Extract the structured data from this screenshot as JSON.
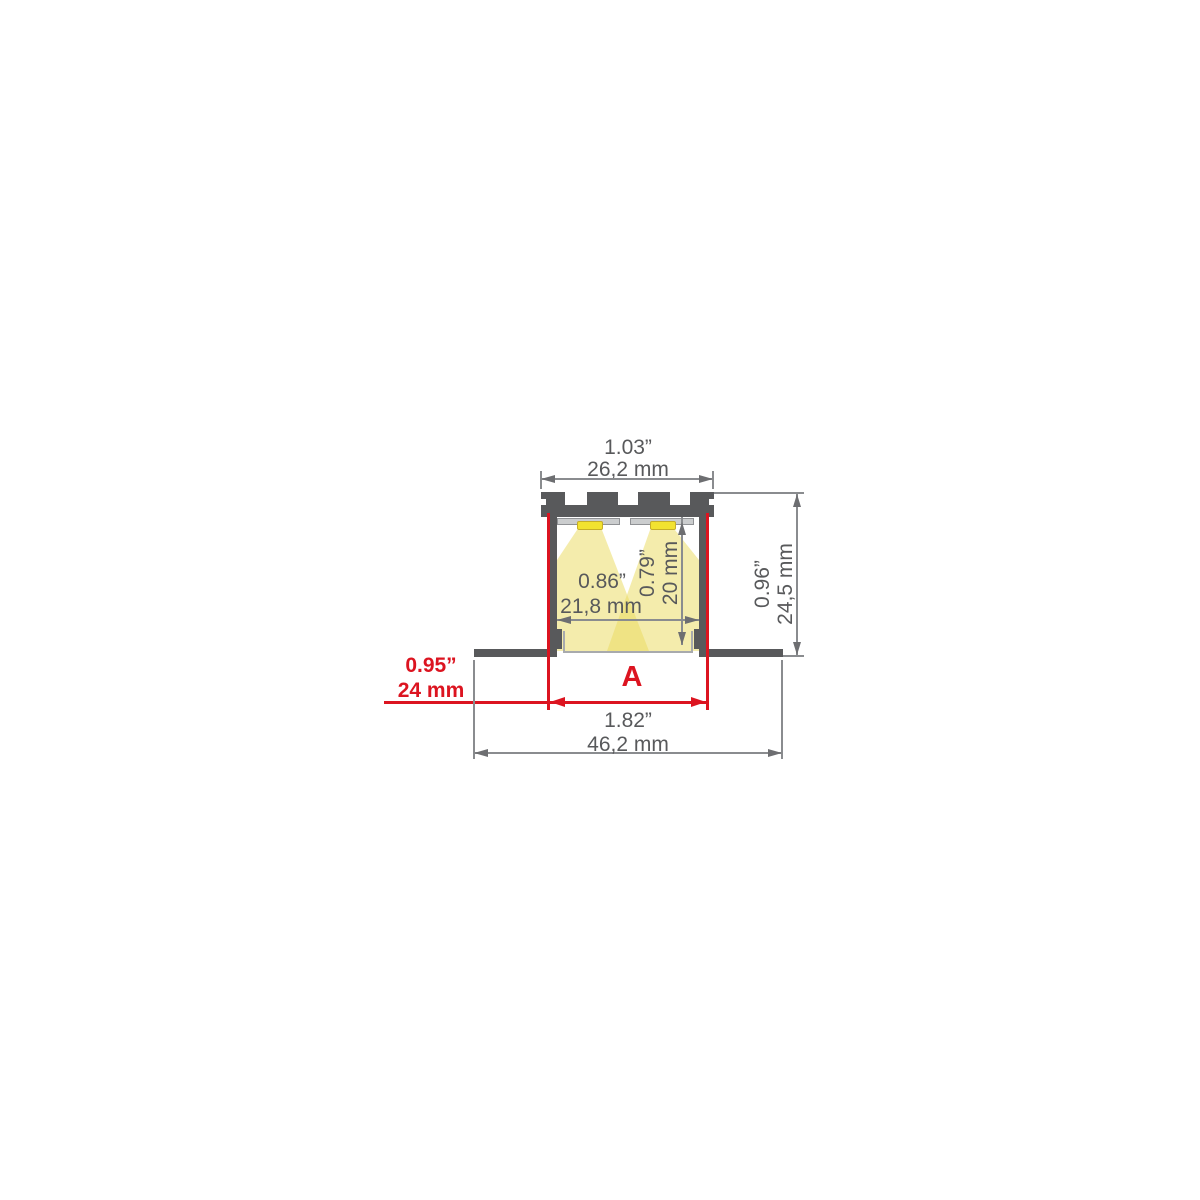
{
  "diagram": {
    "kind": "led-aluminum-profile-cross-section",
    "dimensions": {
      "top_width": {
        "inch": "1.03”",
        "mm": "26,2 mm"
      },
      "inner_width": {
        "inch": "0.86”",
        "mm": "21,8 mm"
      },
      "inner_height": {
        "inch": "0.79”",
        "mm": "20 mm"
      },
      "overall_height": {
        "inch": "0.96”",
        "mm": "24,5 mm"
      },
      "cutout_width": {
        "inch": "0.95”",
        "mm": "24 mm",
        "label": "A"
      },
      "overall_width": {
        "inch": "1.82”",
        "mm": "46,2 mm"
      }
    },
    "colors": {
      "profile_body": "#58595b",
      "dimension_line": "#8a8c8f",
      "dimension_arrow": "#6d6e71",
      "dimension_text": "#58595b",
      "highlight_red": "#dc1420",
      "led_yellow": "#f2e230",
      "light_cone": "#f5efb2",
      "pcb_gray": "#cbcdce",
      "diffuser_gray": "#a8aaad",
      "background": "#ffffff"
    }
  }
}
